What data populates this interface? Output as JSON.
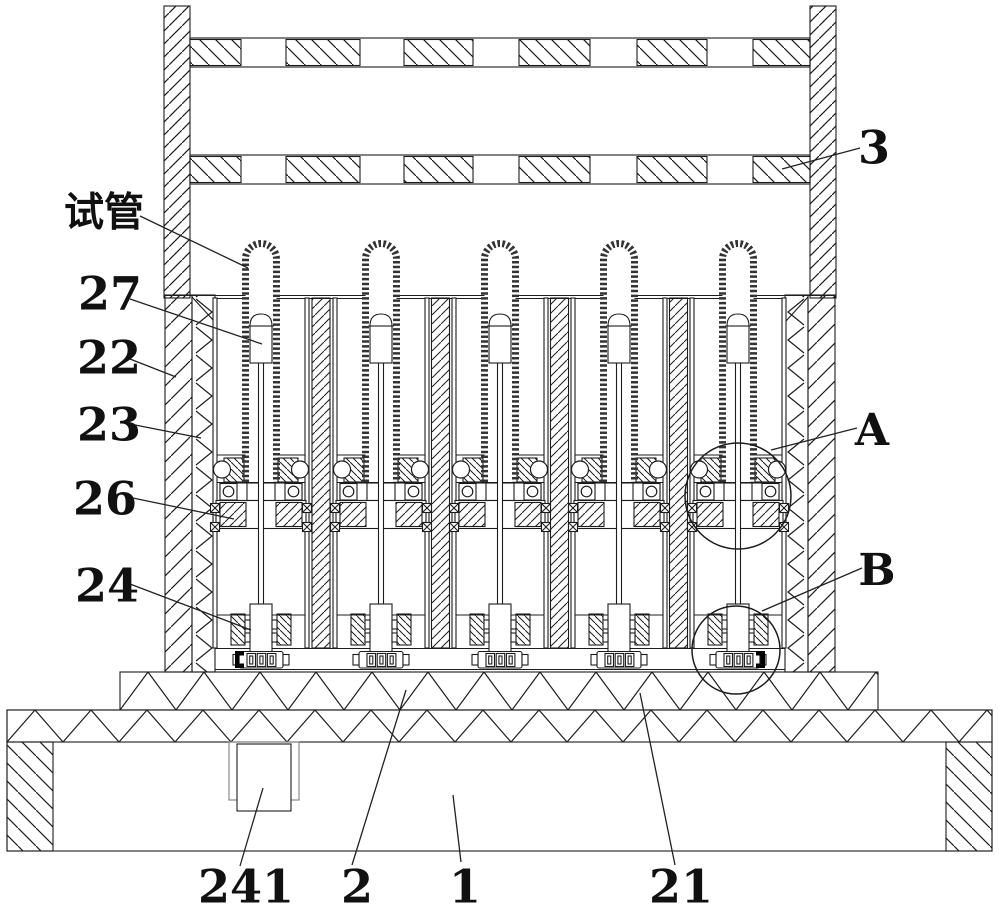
{
  "colors": {
    "background": "#ffffff",
    "line": "#1c1c1c",
    "stipple": "#333333",
    "leader": "#222222",
    "motor_bracket": "#888888"
  },
  "figure": {
    "tube_count": 5,
    "detail_circles": [
      "A",
      "B"
    ]
  },
  "callouts": [
    {
      "id": "label-test-tube",
      "text": "试管",
      "x": 104,
      "y": 211,
      "size": 40,
      "cjk": true,
      "leader": [
        [
          140,
          216
        ],
        [
          248,
          268
        ]
      ]
    },
    {
      "id": "label-27",
      "text": "27",
      "x": 110,
      "y": 293,
      "size": 46,
      "leader": [
        [
          130,
          299
        ],
        [
          262,
          344
        ]
      ]
    },
    {
      "id": "label-22",
      "text": "22",
      "x": 109,
      "y": 357,
      "size": 46,
      "leader": [
        [
          130,
          359
        ],
        [
          176,
          377
        ]
      ]
    },
    {
      "id": "label-23",
      "text": "23",
      "x": 109,
      "y": 424,
      "size": 46,
      "leader": [
        [
          130,
          424
        ],
        [
          201,
          438
        ]
      ]
    },
    {
      "id": "label-26",
      "text": "26",
      "x": 105,
      "y": 498,
      "size": 46,
      "leader": [
        [
          128,
          497
        ],
        [
          234,
          519
        ]
      ]
    },
    {
      "id": "label-24",
      "text": "24",
      "x": 107,
      "y": 585,
      "size": 46,
      "leader": [
        [
          130,
          584
        ],
        [
          251,
          630
        ]
      ]
    },
    {
      "id": "label-3",
      "text": "3",
      "x": 874,
      "y": 147,
      "size": 46,
      "leader": [
        [
          860,
          148
        ],
        [
          782,
          169
        ]
      ]
    },
    {
      "id": "label-A",
      "text": "A",
      "x": 872,
      "y": 429,
      "size": 44,
      "leader": [
        [
          857,
          428
        ],
        [
          771,
          450
        ]
      ]
    },
    {
      "id": "label-B",
      "text": "B",
      "x": 877,
      "y": 569,
      "size": 44,
      "leader": [
        [
          862,
          568
        ],
        [
          762,
          611
        ]
      ]
    },
    {
      "id": "label-241",
      "text": "241",
      "x": 246,
      "y": 886,
      "size": 46,
      "leader": [
        [
          240,
          866
        ],
        [
          263,
          788
        ]
      ]
    },
    {
      "id": "label-2",
      "text": "2",
      "x": 357,
      "y": 886,
      "size": 46,
      "leader": [
        [
          352,
          865
        ],
        [
          406,
          690
        ]
      ]
    },
    {
      "id": "label-1",
      "text": "1",
      "x": 465,
      "y": 886,
      "size": 46,
      "leader": [
        [
          461,
          862
        ],
        [
          453,
          795
        ]
      ]
    },
    {
      "id": "label-21",
      "text": "21",
      "x": 681,
      "y": 886,
      "size": 46,
      "leader": [
        [
          675,
          865
        ],
        [
          640,
          693
        ]
      ]
    }
  ]
}
